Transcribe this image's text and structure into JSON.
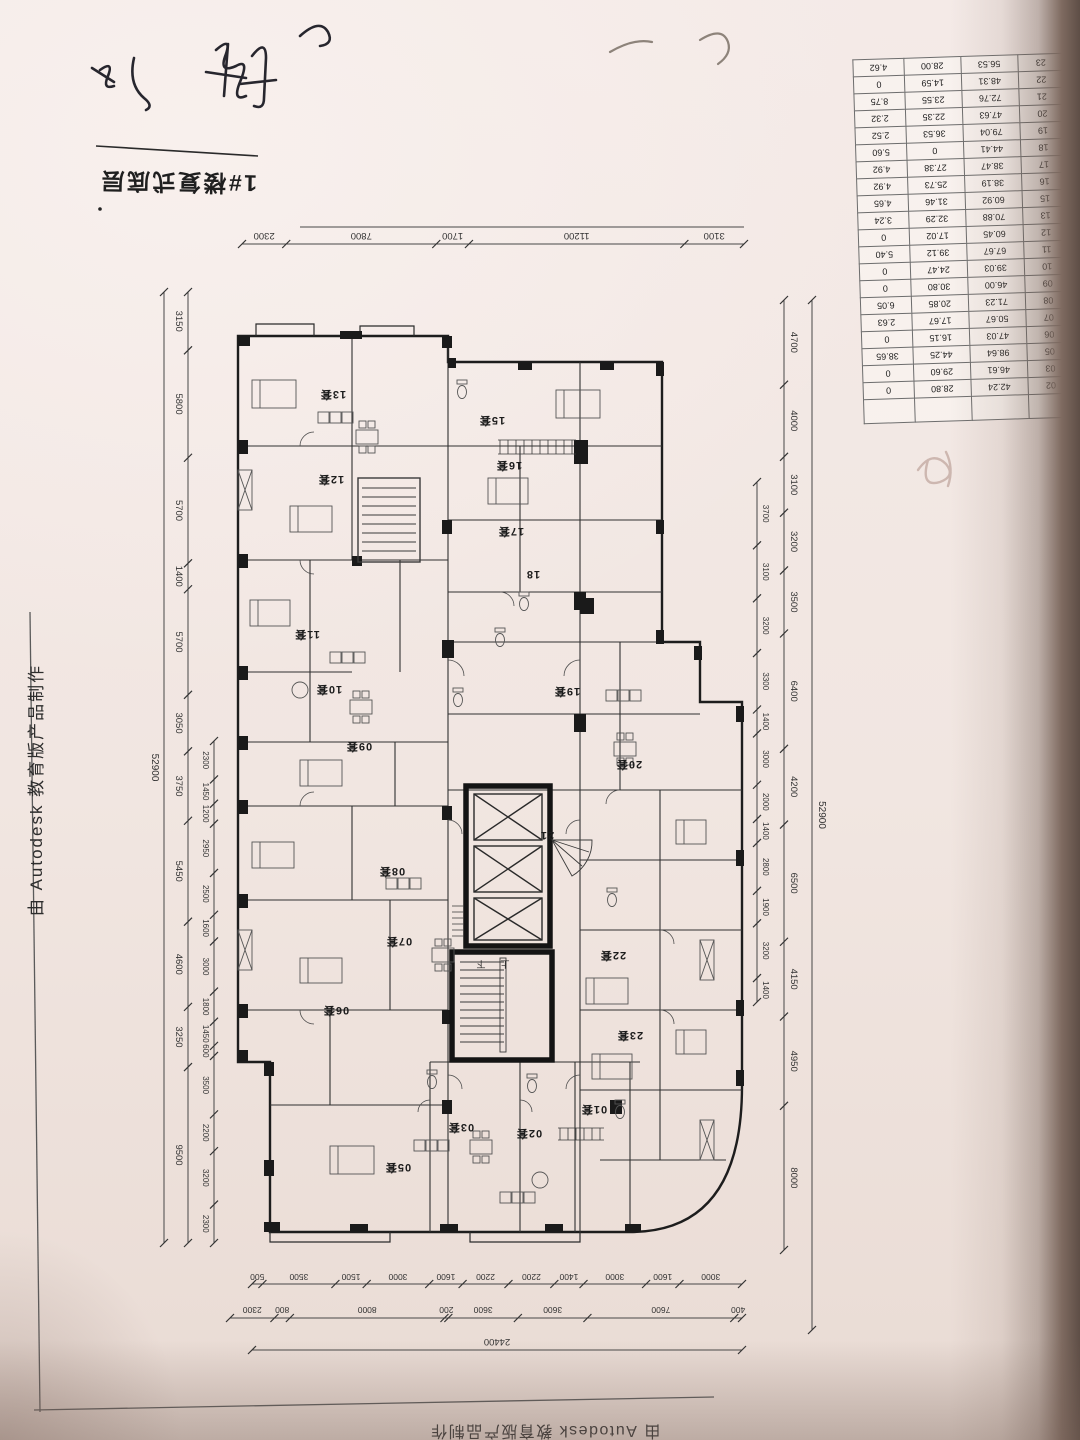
{
  "sheet": {
    "title": "1#楼复式底层",
    "watermark_left": "由 Autodesk 教育版产品制作",
    "watermark_bottom": "由 Autodesk 教育版产品制作"
  },
  "area_table": {
    "rows": [
      [
        "23",
        "56.53",
        "28.00",
        "4.62"
      ],
      [
        "22",
        "48.31",
        "14.59",
        "0"
      ],
      [
        "21",
        "72.76",
        "23.55",
        "8.75"
      ],
      [
        "20",
        "47.63",
        "22.35",
        "2.32"
      ],
      [
        "19",
        "79.04",
        "36.53",
        "2.52"
      ],
      [
        "18",
        "44.41",
        "0",
        "5.60"
      ],
      [
        "17",
        "38.47",
        "27.38",
        "4.92"
      ],
      [
        "16",
        "38.19",
        "25.73",
        "4.92"
      ],
      [
        "15",
        "60.92",
        "31.46",
        "4.65"
      ],
      [
        "13",
        "70.88",
        "32.29",
        "3.24"
      ],
      [
        "12",
        "60.45",
        "17.02",
        "0"
      ],
      [
        "11",
        "67.67",
        "39.12",
        "5.40"
      ],
      [
        "10",
        "39.03",
        "24.47",
        "0"
      ],
      [
        "09",
        "46.00",
        "30.80",
        "0"
      ],
      [
        "08",
        "71.23",
        "20.85",
        "6.05"
      ],
      [
        "07",
        "50.67",
        "17.67",
        "2.63"
      ],
      [
        "06",
        "47.03",
        "16.15",
        "0"
      ],
      [
        "05",
        "98.64",
        "44.25",
        "38.65"
      ],
      [
        "03",
        "46.61",
        "29.60",
        "0"
      ],
      [
        "02",
        "42.24",
        "28.80",
        "0"
      ]
    ]
  },
  "dimensions": {
    "top": [
      "2300",
      "7800",
      "1700",
      "11200",
      "3100"
    ],
    "left_total": "52900",
    "left_main": [
      "3150",
      "5800",
      "5700",
      "1400",
      "5700",
      "3050",
      "3750",
      "5450",
      "4600",
      "3250",
      "9500"
    ],
    "left_inner": [
      "2300",
      "1450",
      "1200",
      "2950",
      "2500",
      "1600",
      "3000",
      "1800",
      "1450",
      "600",
      "3500",
      "2200",
      "3200",
      "2300"
    ],
    "right_total": "52900",
    "right_main": [
      "4700",
      "4000",
      "3100",
      "3200",
      "3500",
      "6400",
      "4200",
      "6500",
      "4150",
      "4950",
      "8000"
    ],
    "right_inner": [
      "3700",
      "3100",
      "3200",
      "3300",
      "1400",
      "3000",
      "2000",
      "1400",
      "2800",
      "1900",
      "3200",
      "1400"
    ],
    "bottom_inner": [
      "500",
      "3500",
      "1500",
      "3000",
      "1600",
      "2200",
      "2200",
      "1400",
      "3000",
      "1600",
      "3000"
    ],
    "bottom_mid": [
      "2300",
      "800",
      "8000",
      "200",
      "3600",
      "3600",
      "7600",
      "400"
    ],
    "bottom_total": "24400"
  },
  "plan": {
    "units": [
      "13套",
      "12套",
      "11套",
      "10套",
      "09套",
      "08套",
      "07套",
      "06套",
      "05套",
      "03套",
      "02套",
      "01套",
      "15套",
      "16套",
      "17套",
      "18",
      "19套",
      "20套",
      "21",
      "22套",
      "23套"
    ],
    "stair_up": "上",
    "stair_down": "下"
  }
}
